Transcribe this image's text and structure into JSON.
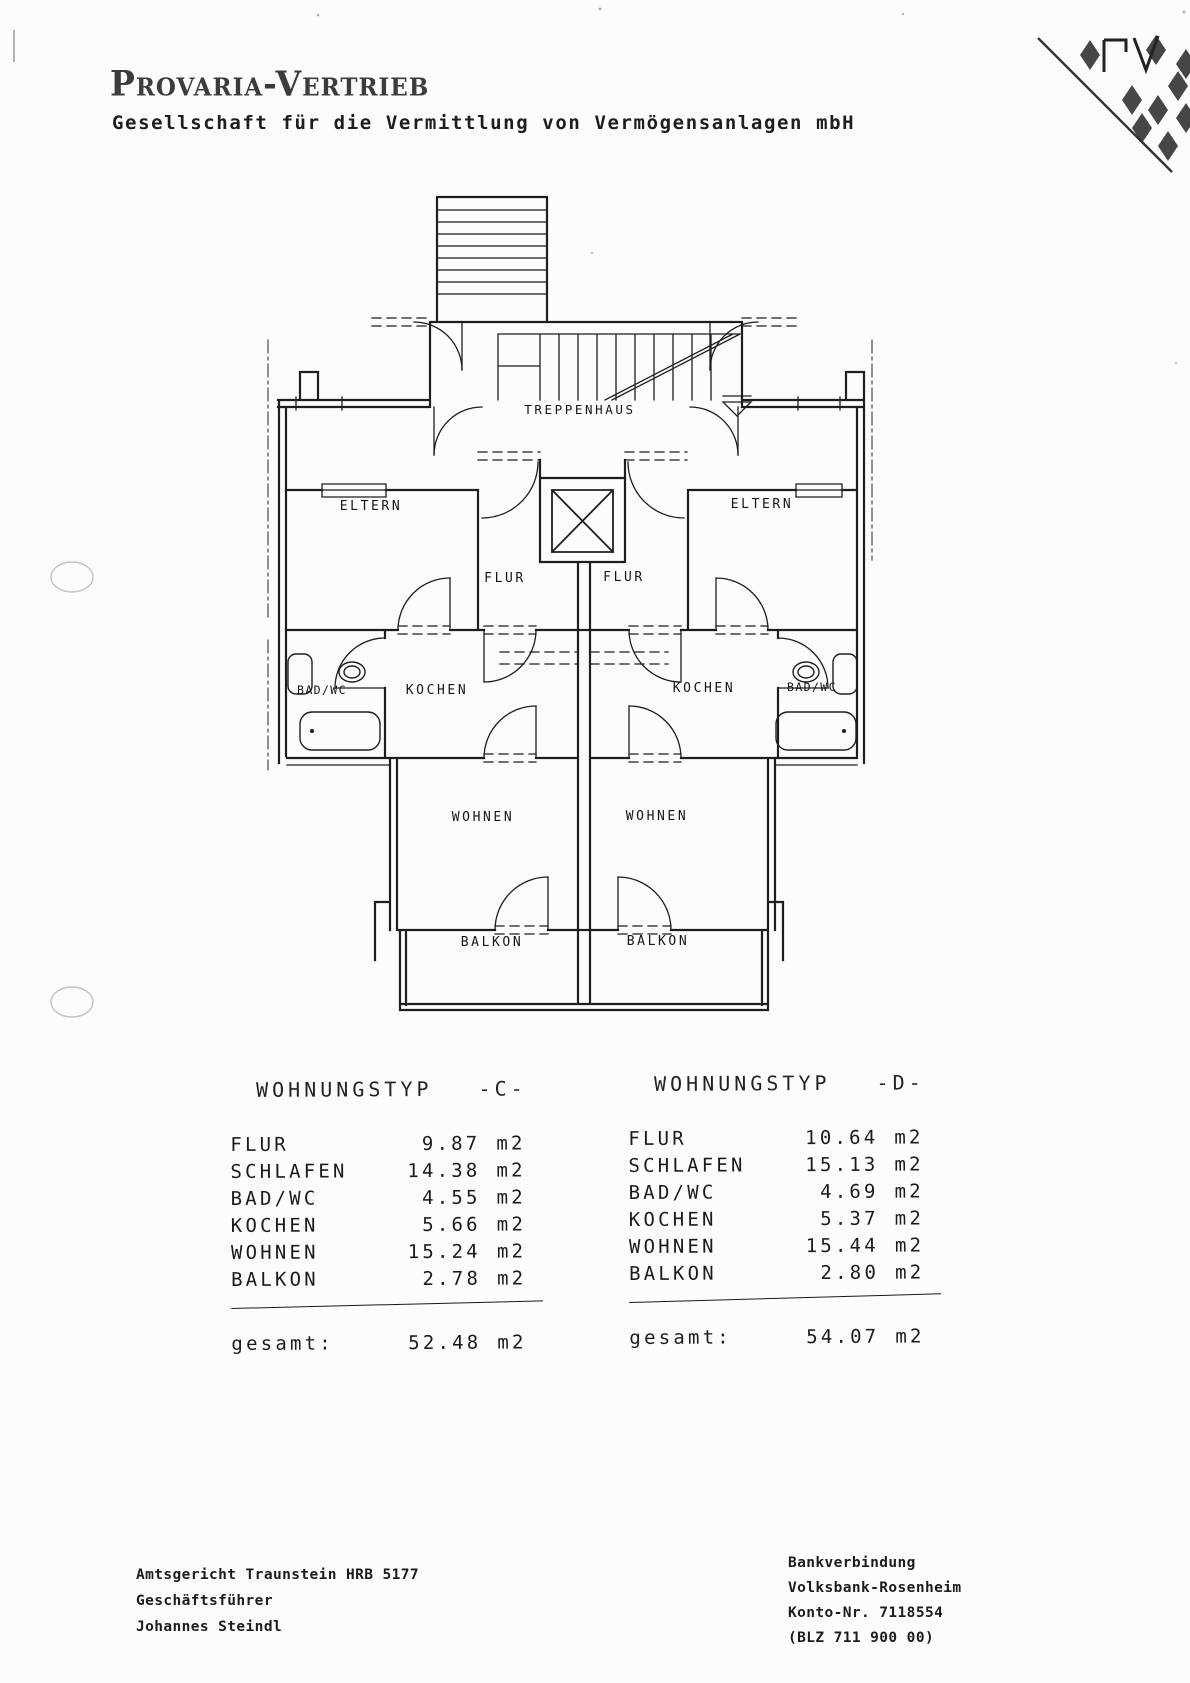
{
  "header": {
    "company_name": "Provaria-Vertrieb",
    "company_subtitle": "Gesellschaft für die Vermittlung von Vermögensanlagen mbH",
    "logo_icon": "bavarian-lozenge-pv-logo"
  },
  "floor_plan": {
    "rooms": {
      "treppenhaus": "TREPPENHAUS",
      "eltern_left": "ELTERN",
      "eltern_right": "ELTERN",
      "flur_left": "FLUR",
      "flur_right": "FLUR",
      "bad_wc_left": "BAD/WC",
      "kochen_left": "KOCHEN",
      "kochen_right": "KOCHEN",
      "bad_wc_right": "BAD/WC",
      "wohnen_left": "WOHNEN",
      "wohnen_right": "WOHNEN",
      "balkon_left": "BALKON",
      "balkon_right": "BALKON"
    }
  },
  "apartment_tables": [
    {
      "title": "WOHNUNGSTYP",
      "code": "-C-",
      "rows": [
        {
          "label": "FLUR",
          "value": "9.87",
          "unit": "m2"
        },
        {
          "label": "SCHLAFEN",
          "value": "14.38",
          "unit": "m2"
        },
        {
          "label": "BAD/WC",
          "value": "4.55",
          "unit": "m2"
        },
        {
          "label": "KOCHEN",
          "value": "5.66",
          "unit": "m2"
        },
        {
          "label": "WOHNEN",
          "value": "15.24",
          "unit": "m2"
        },
        {
          "label": "BALKON",
          "value": "2.78",
          "unit": "m2"
        }
      ],
      "total_label": "gesamt:",
      "total_value": "52.48",
      "total_unit": "m2"
    },
    {
      "title": "WOHNUNGSTYP",
      "code": "-D-",
      "rows": [
        {
          "label": "FLUR",
          "value": "10.64",
          "unit": "m2"
        },
        {
          "label": "SCHLAFEN",
          "value": "15.13",
          "unit": "m2"
        },
        {
          "label": "BAD/WC",
          "value": "4.69",
          "unit": "m2"
        },
        {
          "label": "KOCHEN",
          "value": "5.37",
          "unit": "m2"
        },
        {
          "label": "WOHNEN",
          "value": "15.44",
          "unit": "m2"
        },
        {
          "label": "BALKON",
          "value": "2.80",
          "unit": "m2"
        }
      ],
      "total_label": "gesamt:",
      "total_value": "54.07",
      "total_unit": "m2"
    }
  ],
  "footer": {
    "left_lines": [
      "Amtsgericht Traunstein HRB 5177",
      "Geschäftsführer",
      "Johannes Steindl"
    ],
    "right_lines": [
      "Bankverbindung",
      "Volksbank-Rosenheim",
      "Konto-Nr. 7118554",
      "(BLZ 711 900 00)"
    ]
  }
}
